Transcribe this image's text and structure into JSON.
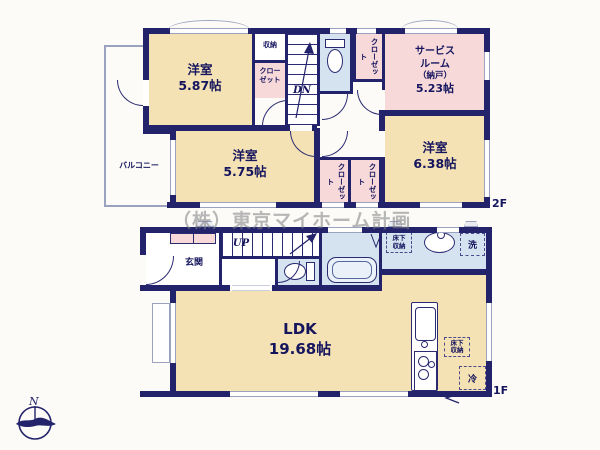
{
  "watermark": "（株）東京マイホーム計画",
  "colors": {
    "wall": "#23236b",
    "room_tan": "#f5e2b4",
    "room_pink": "#f8d9da",
    "room_blue": "#d5e3f1",
    "thin_line": "#9aa2c0",
    "text": "#15155e",
    "watermark_gray": "#7d7d82"
  },
  "floor2": {
    "floor_label": "2F",
    "balcony_label": "バルコニー",
    "room_587": {
      "name": "洋室",
      "size": "5.87帖"
    },
    "storage_label": "収納",
    "closet_a": {
      "line1": "クロー",
      "line2": "ゼット"
    },
    "stairs_label": "DN",
    "closet_b": "クローゼット",
    "service_room": {
      "line1": "サービス",
      "line2": "ルーム",
      "line3": "（納戸）",
      "size": "5.23帖"
    },
    "room_575": {
      "name": "洋室",
      "size": "5.75帖"
    },
    "room_638": {
      "name": "洋室",
      "size": "6.38帖"
    },
    "closet_c": "クローゼット",
    "closet_d": "クローゼット"
  },
  "floor1": {
    "floor_label": "1F",
    "entrance_label": "玄関",
    "stairs_label": "UP",
    "underfloor_bath": {
      "line1": "床下",
      "line2": "収納"
    },
    "laundry_label": "洗",
    "ldk": {
      "name": "LDK",
      "size": "19.68帖"
    },
    "underfloor_kitchen": {
      "line1": "床下",
      "line2": "収納"
    },
    "fridge_label": "冷"
  },
  "compass": {
    "north_label": "N"
  }
}
